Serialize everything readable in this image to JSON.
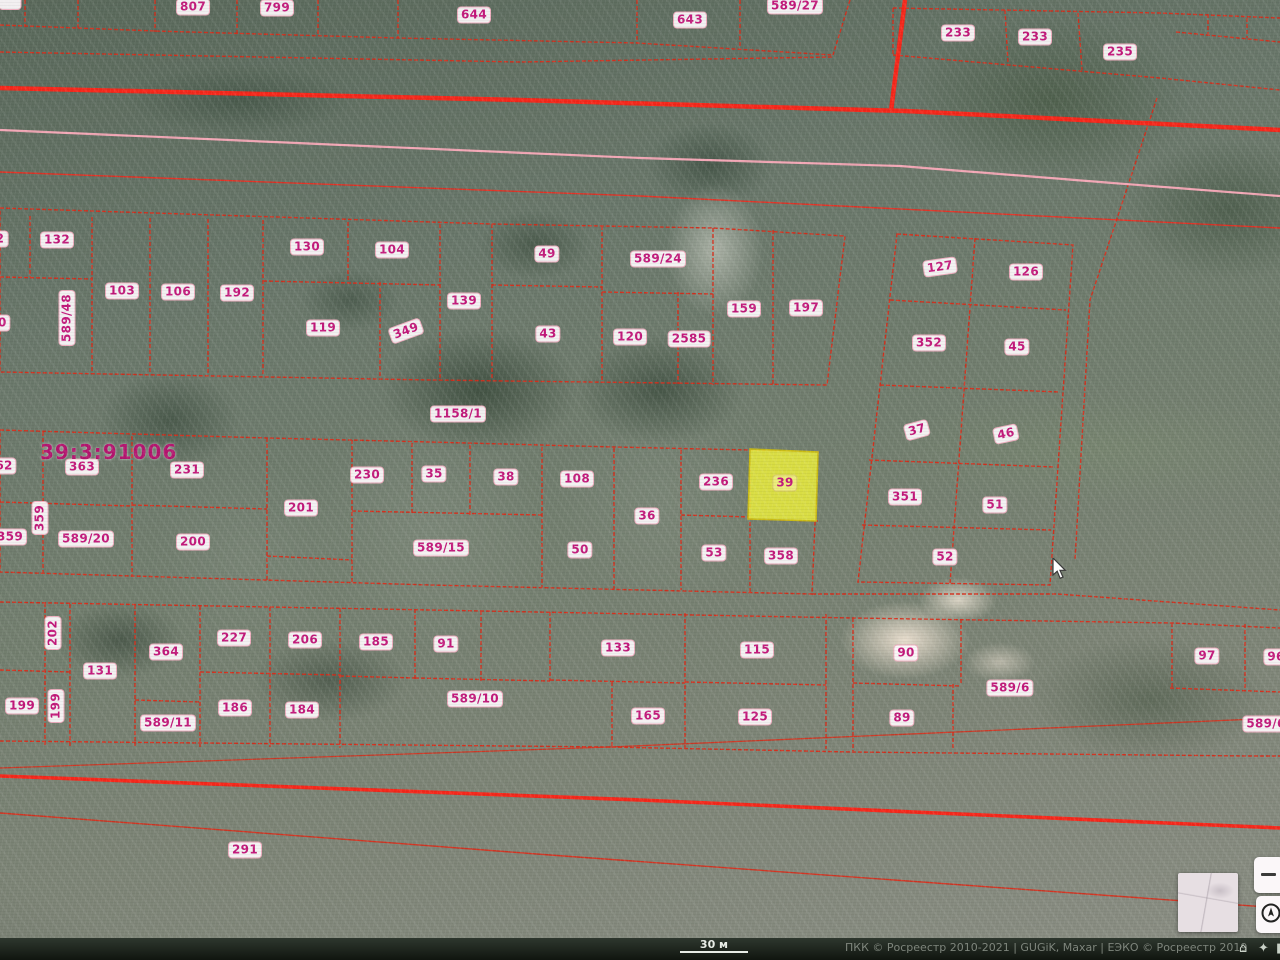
{
  "map": {
    "quarter_label": "39:3:91006",
    "selected_parcel_number": "39",
    "road_parcel_label": "1158/1",
    "accent_colors": {
      "boundary_red": "#d92b18",
      "highway_red": "#f5271a",
      "pink_line": "#f2a7b5",
      "label_text": "#c2187a",
      "selected_fill": "#e7ea3d"
    },
    "parcel_labels": [
      {
        "t": "",
        "x": 10,
        "y": 3
      },
      {
        "t": "807",
        "x": 193,
        "y": 7
      },
      {
        "t": "799",
        "x": 277,
        "y": 8
      },
      {
        "t": "644",
        "x": 474,
        "y": 15
      },
      {
        "t": "643",
        "x": 690,
        "y": 20
      },
      {
        "t": "589/27",
        "x": 795,
        "y": 6
      },
      {
        "t": "233",
        "x": 958,
        "y": 33
      },
      {
        "t": "233",
        "x": 1035,
        "y": 37
      },
      {
        "t": "235",
        "x": 1120,
        "y": 52
      },
      {
        "t": "2",
        "x": 0,
        "y": 239
      },
      {
        "t": "132",
        "x": 57,
        "y": 240
      },
      {
        "t": "80",
        "x": -2,
        "y": 323
      },
      {
        "t": "589/48",
        "x": 67,
        "y": 318,
        "v": 1
      },
      {
        "t": "103",
        "x": 122,
        "y": 291
      },
      {
        "t": "106",
        "x": 178,
        "y": 292
      },
      {
        "t": "192",
        "x": 237,
        "y": 293
      },
      {
        "t": "130",
        "x": 307,
        "y": 247
      },
      {
        "t": "104",
        "x": 392,
        "y": 250
      },
      {
        "t": "119",
        "x": 323,
        "y": 328
      },
      {
        "t": "349",
        "x": 406,
        "y": 331,
        "r": -20
      },
      {
        "t": "139",
        "x": 464,
        "y": 301
      },
      {
        "t": "49",
        "x": 547,
        "y": 254
      },
      {
        "t": "589/24",
        "x": 658,
        "y": 259
      },
      {
        "t": "43",
        "x": 548,
        "y": 334
      },
      {
        "t": "120",
        "x": 630,
        "y": 337
      },
      {
        "t": "2585",
        "x": 689,
        "y": 339
      },
      {
        "t": "159",
        "x": 744,
        "y": 309
      },
      {
        "t": "197",
        "x": 806,
        "y": 308
      },
      {
        "t": "127",
        "x": 940,
        "y": 267,
        "r": -8
      },
      {
        "t": "126",
        "x": 1026,
        "y": 272
      },
      {
        "t": "352",
        "x": 929,
        "y": 343
      },
      {
        "t": "45",
        "x": 1017,
        "y": 347
      },
      {
        "t": "37",
        "x": 917,
        "y": 430,
        "r": -15
      },
      {
        "t": "46",
        "x": 1006,
        "y": 434,
        "r": -12
      },
      {
        "t": "1158/1",
        "x": 458,
        "y": 414
      },
      {
        "t": "62",
        "x": 4,
        "y": 466
      },
      {
        "t": "363",
        "x": 82,
        "y": 467
      },
      {
        "t": "231",
        "x": 187,
        "y": 470
      },
      {
        "t": "230",
        "x": 367,
        "y": 475
      },
      {
        "t": "35",
        "x": 434,
        "y": 474
      },
      {
        "t": "38",
        "x": 506,
        "y": 477
      },
      {
        "t": "108",
        "x": 577,
        "y": 479
      },
      {
        "t": "36",
        "x": 647,
        "y": 516
      },
      {
        "t": "236",
        "x": 716,
        "y": 482
      },
      {
        "t": "39",
        "x": 785,
        "y": 483,
        "sel": 1
      },
      {
        "t": "359",
        "x": 40,
        "y": 518,
        "v": 1
      },
      {
        "t": "359",
        "x": 10,
        "y": 537
      },
      {
        "t": "589/20",
        "x": 86,
        "y": 539
      },
      {
        "t": "200",
        "x": 193,
        "y": 542
      },
      {
        "t": "201",
        "x": 301,
        "y": 508
      },
      {
        "t": "589/15",
        "x": 441,
        "y": 548
      },
      {
        "t": "50",
        "x": 580,
        "y": 550
      },
      {
        "t": "53",
        "x": 714,
        "y": 553
      },
      {
        "t": "358",
        "x": 781,
        "y": 556
      },
      {
        "t": "351",
        "x": 905,
        "y": 497
      },
      {
        "t": "51",
        "x": 995,
        "y": 505
      },
      {
        "t": "52",
        "x": 945,
        "y": 557
      },
      {
        "t": "202",
        "x": 53,
        "y": 633,
        "v": 1
      },
      {
        "t": "364",
        "x": 166,
        "y": 652
      },
      {
        "t": "131",
        "x": 100,
        "y": 671
      },
      {
        "t": "227",
        "x": 234,
        "y": 638
      },
      {
        "t": "206",
        "x": 305,
        "y": 640
      },
      {
        "t": "185",
        "x": 376,
        "y": 642
      },
      {
        "t": "199",
        "x": 22,
        "y": 706
      },
      {
        "t": "199",
        "x": 56,
        "y": 706,
        "v": 1
      },
      {
        "t": "589/11",
        "x": 168,
        "y": 723
      },
      {
        "t": "186",
        "x": 235,
        "y": 708
      },
      {
        "t": "184",
        "x": 302,
        "y": 710
      },
      {
        "t": "91",
        "x": 446,
        "y": 644
      },
      {
        "t": "133",
        "x": 618,
        "y": 648
      },
      {
        "t": "115",
        "x": 757,
        "y": 650
      },
      {
        "t": "589/10",
        "x": 475,
        "y": 699
      },
      {
        "t": "165",
        "x": 648,
        "y": 716
      },
      {
        "t": "125",
        "x": 755,
        "y": 717
      },
      {
        "t": "90",
        "x": 906,
        "y": 653
      },
      {
        "t": "589/6",
        "x": 1010,
        "y": 688
      },
      {
        "t": "89",
        "x": 902,
        "y": 718
      },
      {
        "t": "97",
        "x": 1207,
        "y": 656
      },
      {
        "t": "96",
        "x": 1276,
        "y": 657
      },
      {
        "t": "589/6",
        "x": 1266,
        "y": 724
      },
      {
        "t": "291",
        "x": 245,
        "y": 850
      }
    ]
  },
  "footer": {
    "scale_label": "30 м",
    "attribution": "ПКК © Росреестр 2010-2021 | GUGiK, Maxar | ЕЭКО © Росреестр 2019",
    "home_icon": "⌂",
    "nav_icon": "✦",
    "cut_icon": "▮"
  }
}
